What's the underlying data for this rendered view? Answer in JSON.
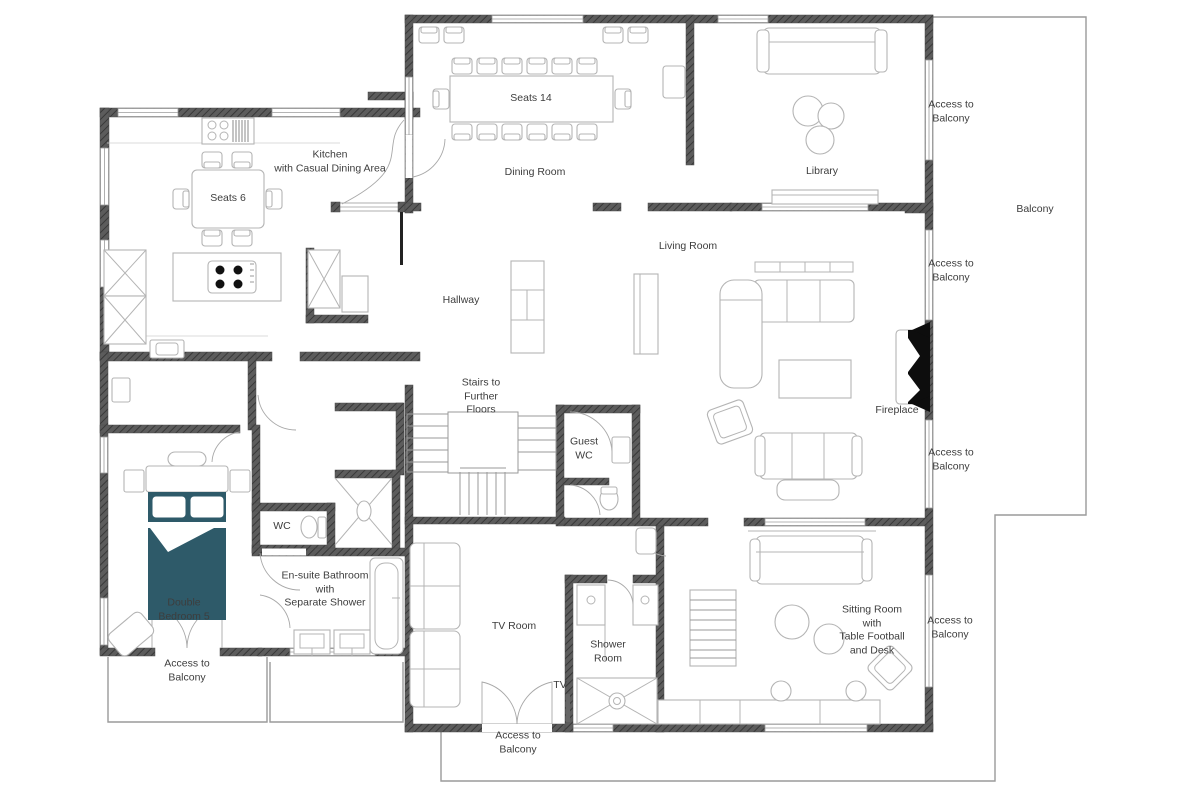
{
  "type": "floor_plan",
  "colors": {
    "wall": "#5c5c5c",
    "wall_hatch": "#383838",
    "furniture": "#b4b4b4",
    "bed": "#2e5a69",
    "fireplace": "#0d0d0d",
    "balcony_line": "#9a9a9a",
    "text": "#3d3d3d",
    "background": "#ffffff"
  },
  "labels": {
    "kitchen": "Kitchen\nwith Casual Dining Area",
    "kitchen_table": "Seats 6",
    "dining_table": "Seats 14",
    "dining_room": "Dining Room",
    "library": "Library",
    "living_room": "Living Room",
    "hallway": "Hallway",
    "stairs": "Stairs to\nFurther\nFloors",
    "guest_wc": "Guest\nWC",
    "fireplace": "Fireplace",
    "balcony": "Balcony",
    "wc": "WC",
    "ensuite_bathroom": "En-suite Bathroom\nwith\nSeparate Shower",
    "double_bedroom": "Double\nBedroom 5",
    "tv_room": "TV Room",
    "tv": "TV",
    "shower_room": "Shower\nRoom",
    "sitting_room": "Sitting Room\nwith\nTable Football\nand Desk",
    "access_to_balcony": "Access to\nBalcony"
  }
}
